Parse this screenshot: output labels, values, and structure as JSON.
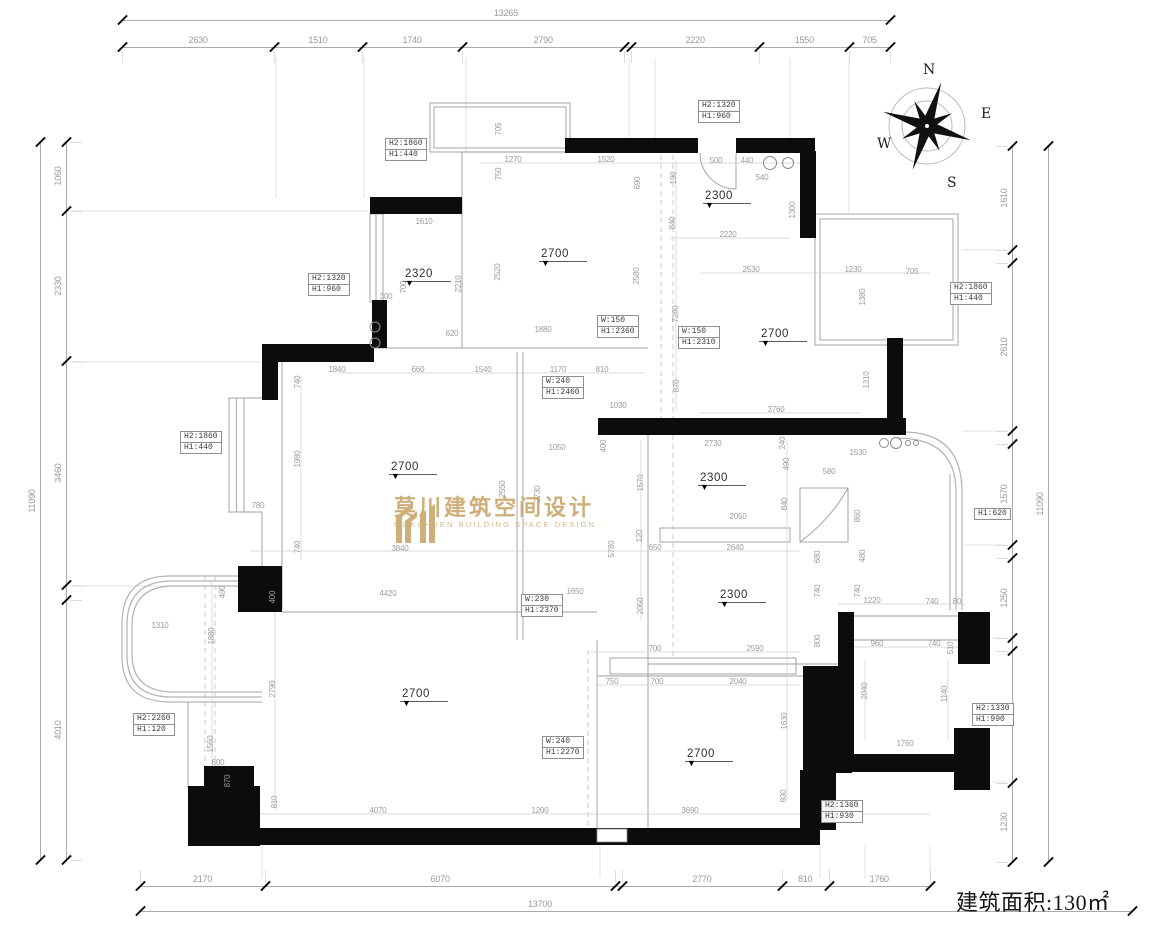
{
  "building_area": {
    "text": "建筑面积:130㎡"
  },
  "compass": {
    "n": "N",
    "e": "E",
    "s": "S",
    "w": "W"
  },
  "watermark": {
    "cn": "莫川建筑空间设计",
    "en": "MOKCHUEN BUILDING SPACE DESIGN"
  },
  "dim_chains": {
    "top": {
      "total": "13265",
      "parts": [
        {
          "v": 2630,
          "l": "2630"
        },
        {
          "v": 1510,
          "l": "1510"
        },
        {
          "v": 1740,
          "l": "1740"
        },
        {
          "v": 2790,
          "l": "2790"
        },
        {
          "v": 120,
          "l": ""
        },
        {
          "v": 2220,
          "l": "2220"
        },
        {
          "v": 1550,
          "l": "1550"
        },
        {
          "v": 705,
          "l": "705"
        }
      ]
    },
    "bottom": {
      "total": "13700",
      "parts": [
        {
          "v": 2170,
          "l": "2170"
        },
        {
          "v": 6070,
          "l": "6070"
        },
        {
          "v": 120,
          "l": ""
        },
        {
          "v": 2770,
          "l": "2770"
        },
        {
          "v": 810,
          "l": "810"
        },
        {
          "v": 1760,
          "l": "1760"
        }
      ]
    },
    "left": {
      "total": "11090",
      "parts": [
        {
          "v": 1060,
          "l": "1060"
        },
        {
          "v": 2330,
          "l": "2330"
        },
        {
          "v": 3460,
          "l": "3460"
        },
        {
          "v": 230,
          "l": ""
        },
        {
          "v": 4010,
          "l": "4010"
        }
      ]
    },
    "right": {
      "total": "11090",
      "parts": [
        {
          "v": 1610,
          "l": "1610"
        },
        {
          "v": 195,
          "l": ""
        },
        {
          "v": 2610,
          "l": "2610"
        },
        {
          "v": 195,
          "l": ""
        },
        {
          "v": 1570,
          "l": "1570"
        },
        {
          "v": 195,
          "l": ""
        },
        {
          "v": 1250,
          "l": "1250"
        },
        {
          "v": 195,
          "l": ""
        },
        {
          "v": 2040,
          "l": "2040"
        },
        {
          "v": 1230,
          "l": "1230"
        }
      ]
    }
  },
  "room_labels": [
    [
      "2320",
      427,
      268
    ],
    [
      "2700",
      563,
      248
    ],
    [
      "2300",
      727,
      190
    ],
    [
      "2700",
      783,
      328
    ],
    [
      "2700",
      413,
      461
    ],
    [
      "2300",
      722,
      472
    ],
    [
      "2300",
      742,
      589
    ],
    [
      "2700",
      424,
      688
    ],
    [
      "2700",
      709,
      748
    ]
  ],
  "label_boxes": [
    [
      385,
      139,
      [
        "H2:1860",
        "H1:440"
      ]
    ],
    [
      698,
      101,
      [
        "H2:1320",
        "H1:960"
      ]
    ],
    [
      308,
      274,
      [
        "H2:1320",
        "H1:960"
      ]
    ],
    [
      950,
      283,
      [
        "H2:1860",
        "H1:440"
      ]
    ],
    [
      180,
      432,
      [
        "H2:1860",
        "H1:440"
      ]
    ],
    [
      597,
      316,
      [
        "W:150",
        "H1:2360"
      ]
    ],
    [
      678,
      327,
      [
        "W:150",
        "H1:2310"
      ]
    ],
    [
      542,
      377,
      [
        "W:240",
        "H1:2460"
      ]
    ],
    [
      521,
      595,
      [
        "W:230",
        "H1:2370"
      ]
    ],
    [
      974,
      509,
      [
        "H1:620"
      ]
    ],
    [
      133,
      714,
      [
        "H2:2260",
        "H1:120"
      ]
    ],
    [
      542,
      737,
      [
        "W:240",
        "H1:2270"
      ]
    ],
    [
      972,
      704,
      [
        "H2:1330",
        "H1:990"
      ]
    ],
    [
      821,
      801,
      [
        "H2:1360",
        "H1:930"
      ]
    ]
  ],
  "dims": [
    [
      "1270",
      513,
      160,
      0
    ],
    [
      "1520",
      606,
      160,
      0
    ],
    [
      "1610",
      424,
      222,
      0
    ],
    [
      "500",
      716,
      161,
      0
    ],
    [
      "440",
      747,
      161,
      0
    ],
    [
      "540",
      762,
      178,
      0
    ],
    [
      "2220",
      728,
      235,
      0
    ],
    [
      "2530",
      751,
      270,
      0
    ],
    [
      "1230",
      853,
      270,
      0
    ],
    [
      "705",
      912,
      272,
      0
    ],
    [
      "300",
      386,
      297,
      0
    ],
    [
      "620",
      452,
      334,
      0
    ],
    [
      "1880",
      543,
      330,
      0
    ],
    [
      "1840",
      337,
      370,
      0
    ],
    [
      "660",
      418,
      370,
      0
    ],
    [
      "1540",
      483,
      370,
      0
    ],
    [
      "1170",
      558,
      370,
      0
    ],
    [
      "810",
      602,
      370,
      0
    ],
    [
      "1030",
      618,
      406,
      0
    ],
    [
      "3760",
      776,
      410,
      0
    ],
    [
      "1050",
      557,
      448,
      0
    ],
    [
      "2730",
      713,
      444,
      0
    ],
    [
      "1530",
      858,
      453,
      0
    ],
    [
      "580",
      829,
      472,
      0
    ],
    [
      "2050",
      738,
      517,
      0
    ],
    [
      "650",
      655,
      548,
      0
    ],
    [
      "2640",
      735,
      548,
      0
    ],
    [
      "3840",
      400,
      549,
      0
    ],
    [
      "780",
      258,
      506,
      0
    ],
    [
      "4420",
      388,
      594,
      0
    ],
    [
      "1650",
      575,
      592,
      0
    ],
    [
      "1310",
      160,
      626,
      0
    ],
    [
      "600",
      218,
      763,
      0
    ],
    [
      "1220",
      872,
      601,
      0
    ],
    [
      "740",
      932,
      602,
      0
    ],
    [
      "80",
      957,
      602,
      0
    ],
    [
      "960",
      877,
      644,
      0
    ],
    [
      "740",
      934,
      644,
      0
    ],
    [
      "700",
      655,
      649,
      0
    ],
    [
      "2590",
      755,
      649,
      0
    ],
    [
      "750",
      612,
      682,
      0
    ],
    [
      "700",
      657,
      682,
      0
    ],
    [
      "2040",
      738,
      682,
      0
    ],
    [
      "1760",
      905,
      744,
      0
    ],
    [
      "1200",
      540,
      811,
      0
    ],
    [
      "4070",
      378,
      811,
      0
    ],
    [
      "3690",
      690,
      811,
      0
    ],
    [
      "705",
      499,
      129,
      1
    ],
    [
      "750",
      499,
      174,
      1
    ],
    [
      "690",
      638,
      183,
      1
    ],
    [
      "190",
      674,
      178,
      1
    ],
    [
      "840",
      673,
      223,
      1
    ],
    [
      "1300",
      793,
      210,
      1
    ],
    [
      "700",
      404,
      287,
      1
    ],
    [
      "2210",
      459,
      284,
      1
    ],
    [
      "2520",
      498,
      272,
      1
    ],
    [
      "2580",
      637,
      276,
      1
    ],
    [
      "1380",
      863,
      297,
      1
    ],
    [
      "7260",
      676,
      314,
      1
    ],
    [
      "1310",
      867,
      380,
      1
    ],
    [
      "870",
      677,
      386,
      1
    ],
    [
      "740",
      298,
      382,
      1
    ],
    [
      "1980",
      298,
      459,
      1
    ],
    [
      "740",
      298,
      547,
      1
    ],
    [
      "2550",
      503,
      489,
      1
    ],
    [
      "2730",
      538,
      494,
      1
    ],
    [
      "400",
      604,
      446,
      1
    ],
    [
      "1570",
      641,
      483,
      1
    ],
    [
      "240",
      783,
      443,
      1
    ],
    [
      "490",
      787,
      464,
      1
    ],
    [
      "840",
      785,
      504,
      1
    ],
    [
      "860",
      858,
      516,
      1
    ],
    [
      "120",
      640,
      536,
      1
    ],
    [
      "5780",
      612,
      549,
      1
    ],
    [
      "680",
      818,
      557,
      1
    ],
    [
      "480",
      863,
      556,
      1
    ],
    [
      "740",
      818,
      591,
      1
    ],
    [
      "740",
      858,
      591,
      1
    ],
    [
      "2050",
      641,
      606,
      1
    ],
    [
      "800",
      818,
      641,
      1
    ],
    [
      "510",
      951,
      648,
      1
    ],
    [
      "490",
      223,
      592,
      1
    ],
    [
      "1880",
      212,
      636,
      1
    ],
    [
      "400",
      273,
      597,
      1
    ],
    [
      "2790",
      273,
      689,
      1
    ],
    [
      "1560",
      211,
      744,
      1
    ],
    [
      "870",
      228,
      781,
      1
    ],
    [
      "810",
      275,
      802,
      1
    ],
    [
      "1630",
      785,
      721,
      1
    ],
    [
      "930",
      784,
      796,
      1
    ],
    [
      "2040",
      865,
      691,
      1
    ],
    [
      "1140",
      945,
      694,
      1
    ]
  ]
}
